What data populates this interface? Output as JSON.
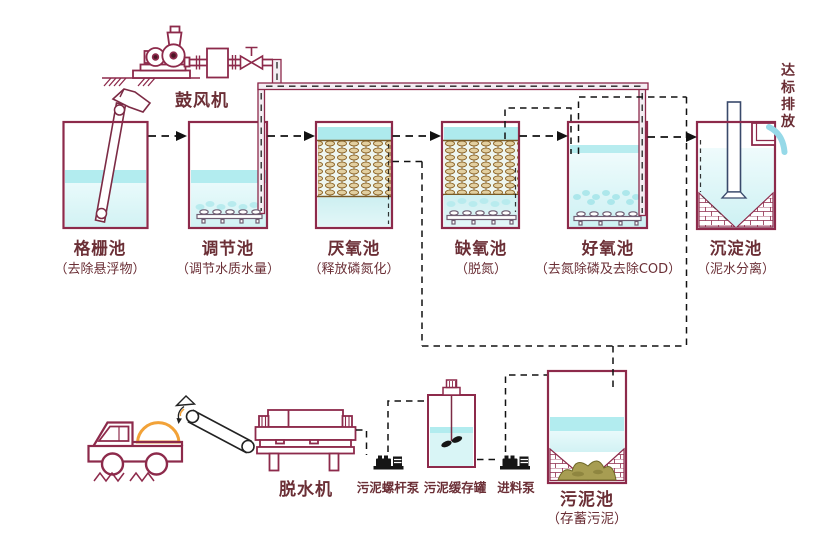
{
  "colors": {
    "outline": "#8d2a4b",
    "text": "#6b2f36",
    "water": "#b2ecef",
    "media": "#e2cfa0",
    "sludge": "#a79d52",
    "orange": "#f2a238",
    "flow": "#111111"
  },
  "blower": {
    "label": "鼓风机"
  },
  "process_tanks": [
    {
      "label": "格栅池",
      "note": "（去除悬浮物）"
    },
    {
      "label": "调节池",
      "note": "（调节水质水量）"
    },
    {
      "label": "厌氧池",
      "note": "（释放磷氮化）"
    },
    {
      "label": "缺氧池",
      "note": "（脱氮）"
    },
    {
      "label": "好氧池",
      "note": "（去氮除磷及去除COD）"
    },
    {
      "label": "沉淀池",
      "note": "（泥水分离）"
    }
  ],
  "discharge": {
    "label": "达标排放"
  },
  "sludge_line": {
    "dewaterer": {
      "label": "脱水机"
    },
    "screw_pump": {
      "label": "污泥螺杆泵"
    },
    "buffer_tank": {
      "label": "污泥缓存罐"
    },
    "feed_pump": {
      "label": "进料泵"
    },
    "sludge_pool": {
      "label": "污泥池",
      "note": "（存蓄污泥）"
    }
  }
}
